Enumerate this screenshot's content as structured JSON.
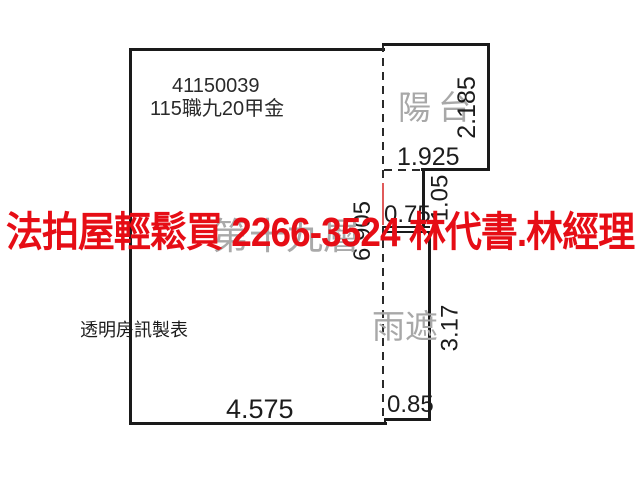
{
  "watermark": {
    "text": "法拍屋輕鬆買 2266-3524 林代書.林經理",
    "color": "#e60d15"
  },
  "plan": {
    "case_number": "41150039",
    "case_code": "115職九20甲金",
    "floor_label": "第十九層",
    "credit_label": "透明房訊製表",
    "areas": {
      "balcony_label": "陽台",
      "rain_shelter_label": "雨遮"
    },
    "dimensions_m": {
      "balcony_width": "1.925",
      "balcony_depth": "2.185",
      "connector_height": "1.05",
      "connector_width": "0.75",
      "unit_right_height": "6.905",
      "rain_shelter_height": "3.17",
      "rain_shelter_width": "0.85",
      "unit_width": "4.575"
    },
    "colors": {
      "wall_line": "#1a1a1a",
      "gray_label": "#a8a8a8",
      "watermark_red": "#e60d15",
      "marker_red": "#e05a5a"
    }
  }
}
